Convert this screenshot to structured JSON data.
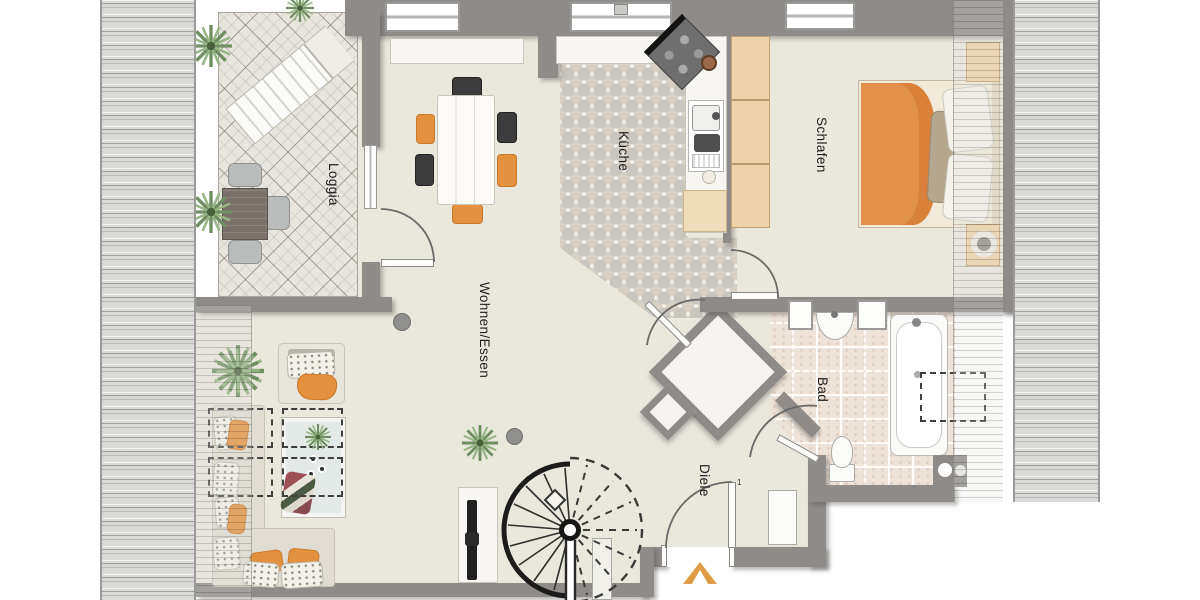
{
  "plan": {
    "title": "Apartment floor plan (attic storey)",
    "rooms": {
      "loggia": {
        "label": "Loggia"
      },
      "wohnen_essen": {
        "label": "Wohnen/Essen"
      },
      "kueche": {
        "label": "Küche"
      },
      "schlafen": {
        "label": "Schlafen"
      },
      "bad": {
        "label": "Bad"
      },
      "diele": {
        "label": "Diele"
      }
    },
    "annotations": {
      "entrance_door_number": "1"
    },
    "markers": {
      "entrance_arrow": "chevron-up"
    },
    "colors": {
      "wall": "#8e8b88",
      "floor": "#eae7dd",
      "kitchen_tile": "#d8d0c3",
      "bath_tile": "#eee3d9",
      "roof_stripe": "#d9d9d7",
      "accent_orange": "#e0913f",
      "wood": "#ecd2a9"
    }
  }
}
